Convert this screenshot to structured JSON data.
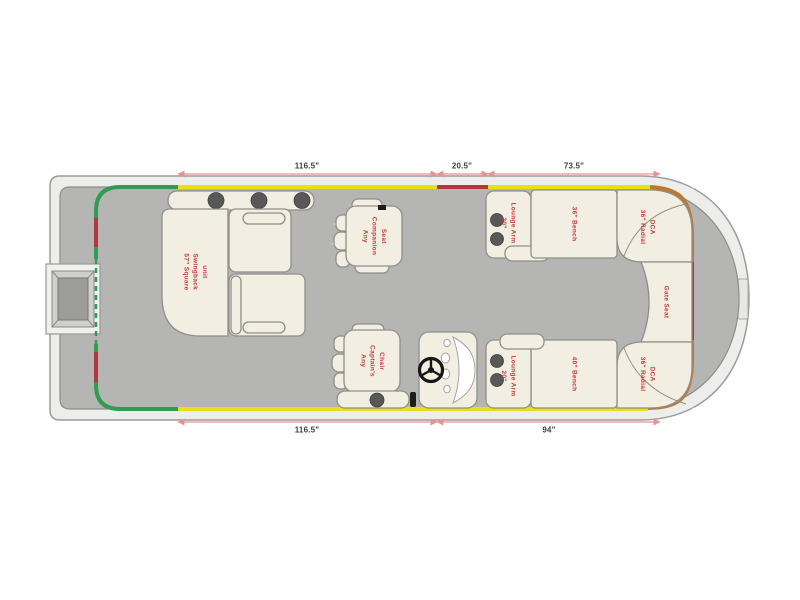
{
  "diagram_title": "Pontoon boat floor plan",
  "colors": {
    "deck_fill": "#b5b5b4",
    "deck_stroke": "#8d8d8c",
    "hull_fill": "#ededec",
    "hull_stroke": "#9c9c9b",
    "furniture_fill": "#f2efe2",
    "furniture_stroke": "#8f8f8a",
    "rail_yellow": "#e9df12",
    "rail_red": "#b43440",
    "rail_green": "#2f9c52",
    "rail_orange": "#c2772f",
    "label_red": "#c73a3c",
    "dim_line": "#e59494",
    "dim_text": "#3e3e46",
    "cupholder": "#585858"
  },
  "seats": {
    "swingback": {
      "label": "57\" Square\nSwingback\nunit"
    },
    "companion_seat": {
      "label": "Any\nCompanion\nSeat"
    },
    "captains_chair": {
      "label": "Any\nCaptain's\nChair"
    },
    "lounge_arm_top": {
      "label": "20\"\nLounge Arm"
    },
    "bench_top": {
      "label": "36\" Bench"
    },
    "radial_top": {
      "label": "36\" Radial\nDCA"
    },
    "gate_seat": {
      "label": "Gate Seat"
    },
    "radial_bottom": {
      "label": "36\" Radial\nDCA"
    },
    "bench_bottom": {
      "label": "40\" Bench"
    },
    "lounge_arm_bottom": {
      "label": "20\"\nLounge Arm"
    }
  },
  "dimensions": {
    "top": [
      {
        "label": "116.5\""
      },
      {
        "label": "20.5\""
      },
      {
        "label": "73.5\""
      }
    ],
    "bottom": [
      {
        "label": "116.5\""
      },
      {
        "label": "94\""
      }
    ]
  }
}
